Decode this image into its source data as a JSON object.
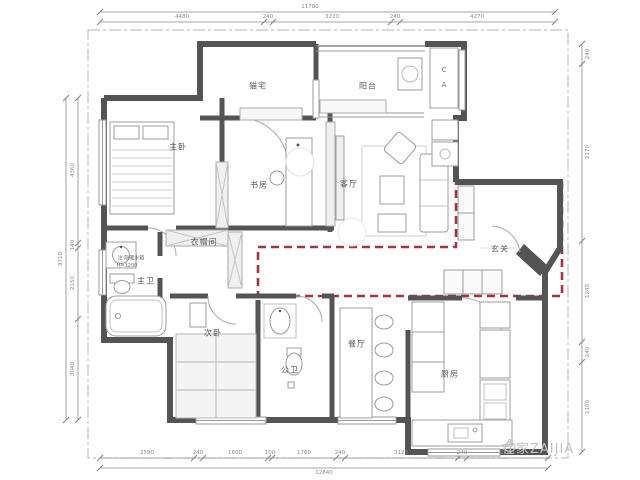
{
  "rooms": {
    "master_bedroom": "主卧",
    "cat_room": "猫宅",
    "balcony": "阳台",
    "study": "书房",
    "living_room": "客厅",
    "entry": "玄关",
    "walk_in_closet": "衣帽间",
    "master_bath": "主卫",
    "second_bedroom": "次卧",
    "public_bath": "公卫",
    "dining_room": "餐厅",
    "kitchen": "厨房"
  },
  "annotations": {
    "bath_note_line1": "注·隐藏水箱",
    "bath_note_line2": "H=1200",
    "ac_letter_top": "C",
    "ac_letter_bottom": "A"
  },
  "dimensions": {
    "top": {
      "total": "11780",
      "segs": [
        "4480",
        "240",
        "3220",
        "240",
        "4270"
      ]
    },
    "bottom": {
      "total": "12840",
      "segs": [
        "2590",
        "240",
        "1800",
        "100",
        "1760",
        "240",
        "3120",
        "240",
        "2240"
      ]
    },
    "left": {
      "total": "9710",
      "segs": [
        "4360",
        "140",
        "2150",
        "3040"
      ]
    },
    "right": {
      "segs": [
        "240",
        "2170",
        "1240",
        "240",
        "1100"
      ]
    }
  },
  "watermark": {
    "text": "在家ZAIJIA"
  },
  "colors": {
    "highlight_red": "#a33640",
    "wall_gray": "#545454",
    "line_gray": "#999999",
    "dim_gray": "#8a8a8a",
    "watermark_gray": "#c3c3c3"
  }
}
